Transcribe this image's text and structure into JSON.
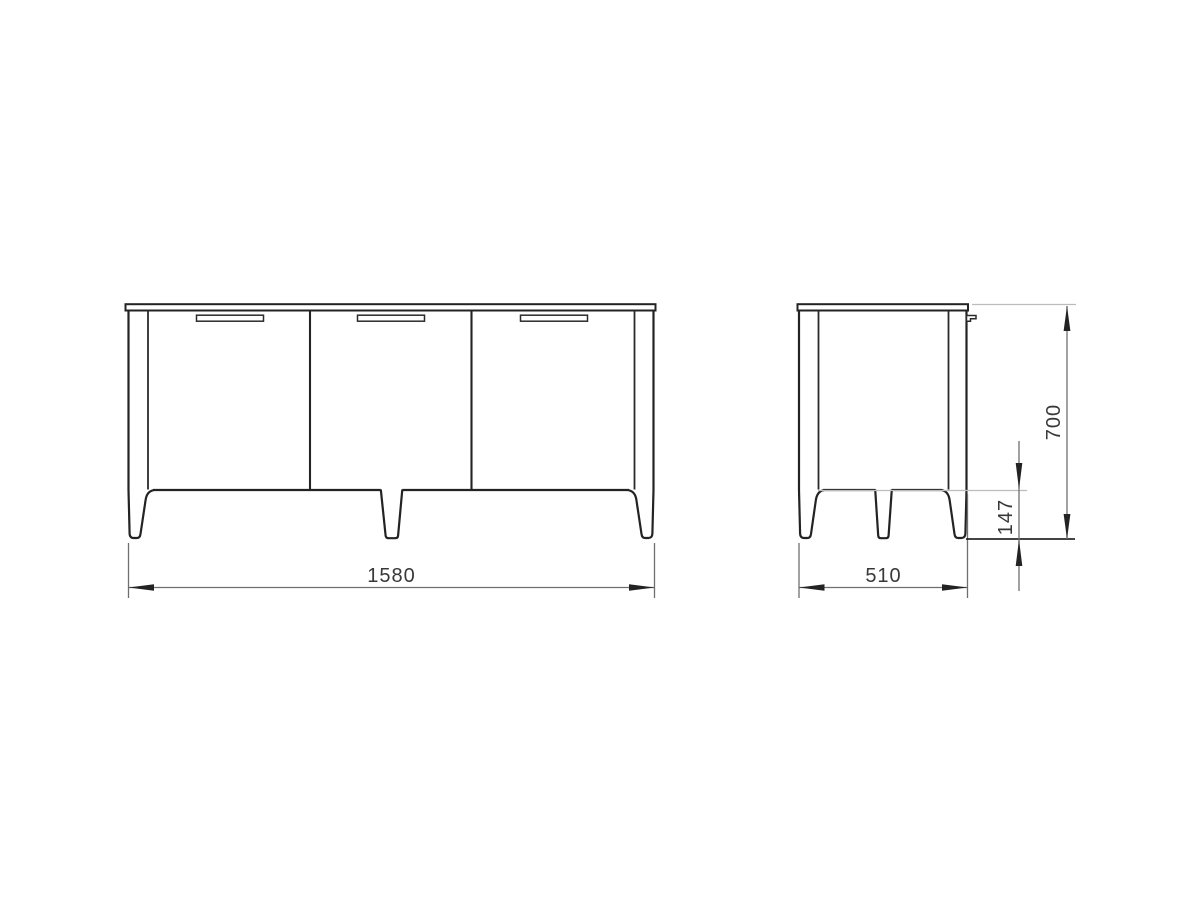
{
  "dimensions": {
    "front_width": "1580",
    "depth": "510",
    "height": "700",
    "leg_height": "147"
  },
  "colors": {
    "background": "#ffffff",
    "cabinet_outline": "#232323",
    "dimension_line": "#6f6f6f",
    "extension_line_light": "#bcbcbc",
    "label_text": "#383838"
  }
}
